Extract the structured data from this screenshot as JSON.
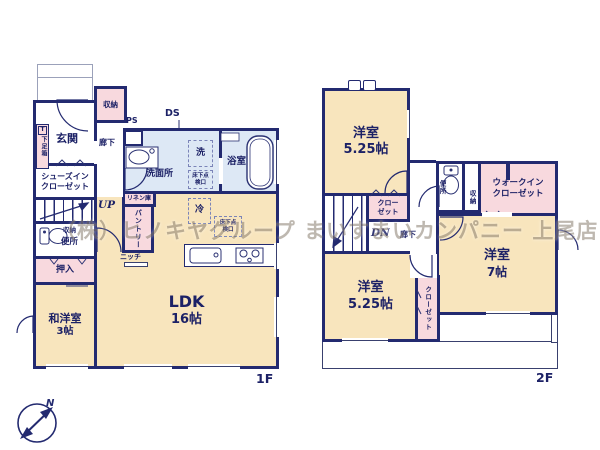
{
  "colors": {
    "wall": "#232a70",
    "text": "#1c2166",
    "cream": "#f8e5bd",
    "pink": "#f8d9de",
    "blue": "#dde8f5",
    "watermark": "#8a7f70"
  },
  "watermark": "（株）ヒノキヤグループ まいすまいカンパニー 上尾店",
  "compass": {
    "north": "N"
  },
  "floor1": {
    "floor_label": "1F",
    "genkan": "玄関",
    "shoe_box_tag": "T",
    "shoe_box": "下足箱",
    "storage_top": "収納",
    "corridor": "廊下",
    "shoes_closet_line1": "シューズイン",
    "shoes_closet_line2": "クローゼット",
    "stairs": "UP",
    "toilet_storage": "収納",
    "toilet": "便所",
    "oshiire": "押入",
    "tatami_room_name": "和洋室",
    "tatami_room_size": "3帖",
    "ldk_name": "LDK",
    "ldk_size": "16帖",
    "niche": "ニッチ",
    "pantry": "パントリー",
    "linen": "リネン庫",
    "fridge": "冷",
    "washer": "洗",
    "washroom": "洗面所",
    "bathroom": "浴室",
    "ps": "PS",
    "ds": "DS",
    "underfloor_hatch_washroom": "床下点検口",
    "underfloor_hatch_kitchen": "床下点検口"
  },
  "floor2": {
    "floor_label": "2F",
    "room_top_name": "洋室",
    "room_top_size": "5.25帖",
    "hall_closet_line1": "クロー",
    "hall_closet_line2": "ゼット",
    "stairs": "DN",
    "corridor": "廊下",
    "toilet": "便所",
    "storage": "収納",
    "wic_line1": "ウォークイン",
    "wic_line2": "クローゼット",
    "room_right_name": "洋室",
    "room_right_size": "7帖",
    "room_bottom_name": "洋室",
    "room_bottom_size": "5.25帖",
    "closet": "クローゼット"
  }
}
